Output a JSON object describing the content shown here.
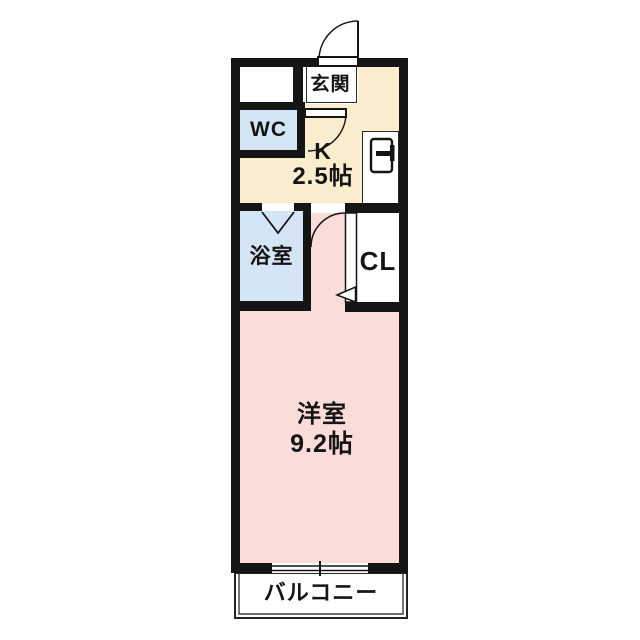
{
  "floorplan": {
    "colors": {
      "wall": "#151515",
      "kitchen": "#f9edcd",
      "water_rooms": "#d4e6f5",
      "main_room": "#fadcd9",
      "background": "#ffffff"
    },
    "rooms": {
      "entrance": {
        "label": "玄関"
      },
      "wc": {
        "label": "WC"
      },
      "kitchen": {
        "label": "K",
        "size": "2.5帖"
      },
      "bathroom": {
        "label": "浴室"
      },
      "closet": {
        "label": "CL"
      },
      "western_room": {
        "label": "洋室",
        "size": "9.2帖"
      },
      "balcony": {
        "label": "バルコニー"
      }
    },
    "icons": {
      "entrance_door": "entrance-door-swing-icon",
      "wc_door": "wc-door-swing-icon",
      "bathroom_door": "folding-door-icon",
      "room_door": "room-door-swing-icon",
      "closet_door": "closet-door-triangle-icon",
      "refrigerator": "refrigerator-icon",
      "window": "sliding-window-icon"
    }
  }
}
